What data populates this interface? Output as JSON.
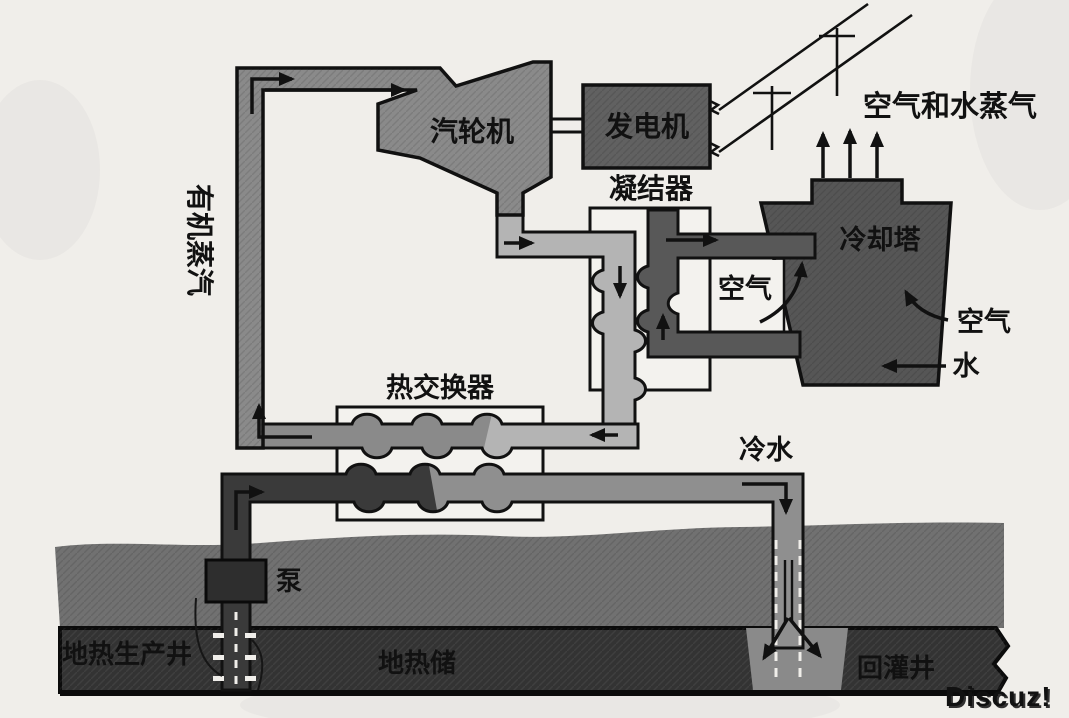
{
  "diagram": {
    "type": "geothermal-binary-cycle-power-plant-schematic",
    "components": {
      "turbine": "汽轮机",
      "generator": "发电机",
      "condenser": "凝结器",
      "cooling_tower": "冷却塔",
      "heat_exchanger": "热交换器",
      "pump": "泵",
      "production_well": "地热生产井",
      "geothermal_reservoir": "地热储",
      "injection_well": "回灌井"
    },
    "flow_labels": {
      "organic_vapor": "有机蒸汽",
      "air_and_water_vapor": "空气和水蒸气",
      "air_left": "空气",
      "air_right": "空气",
      "water": "水",
      "cold_water": "冷水"
    },
    "watermark": "Discuz!",
    "colors": {
      "paper": "#f0eeea",
      "vapor_pipe_gray": "#8a8a8a",
      "condensate_light_gray": "#b4b4b4",
      "hot_brine_dark": "#3a3a3a",
      "cooled_brine_gray": "#8f8f8f",
      "equipment_gray": "#616161",
      "cooling_tower_gray": "#565656",
      "cooling_loop_gray": "#585858",
      "ground_gray": "#717171",
      "reservoir_dark": "#333333",
      "outline": "#111111",
      "watermark_gray": "#979797"
    }
  }
}
